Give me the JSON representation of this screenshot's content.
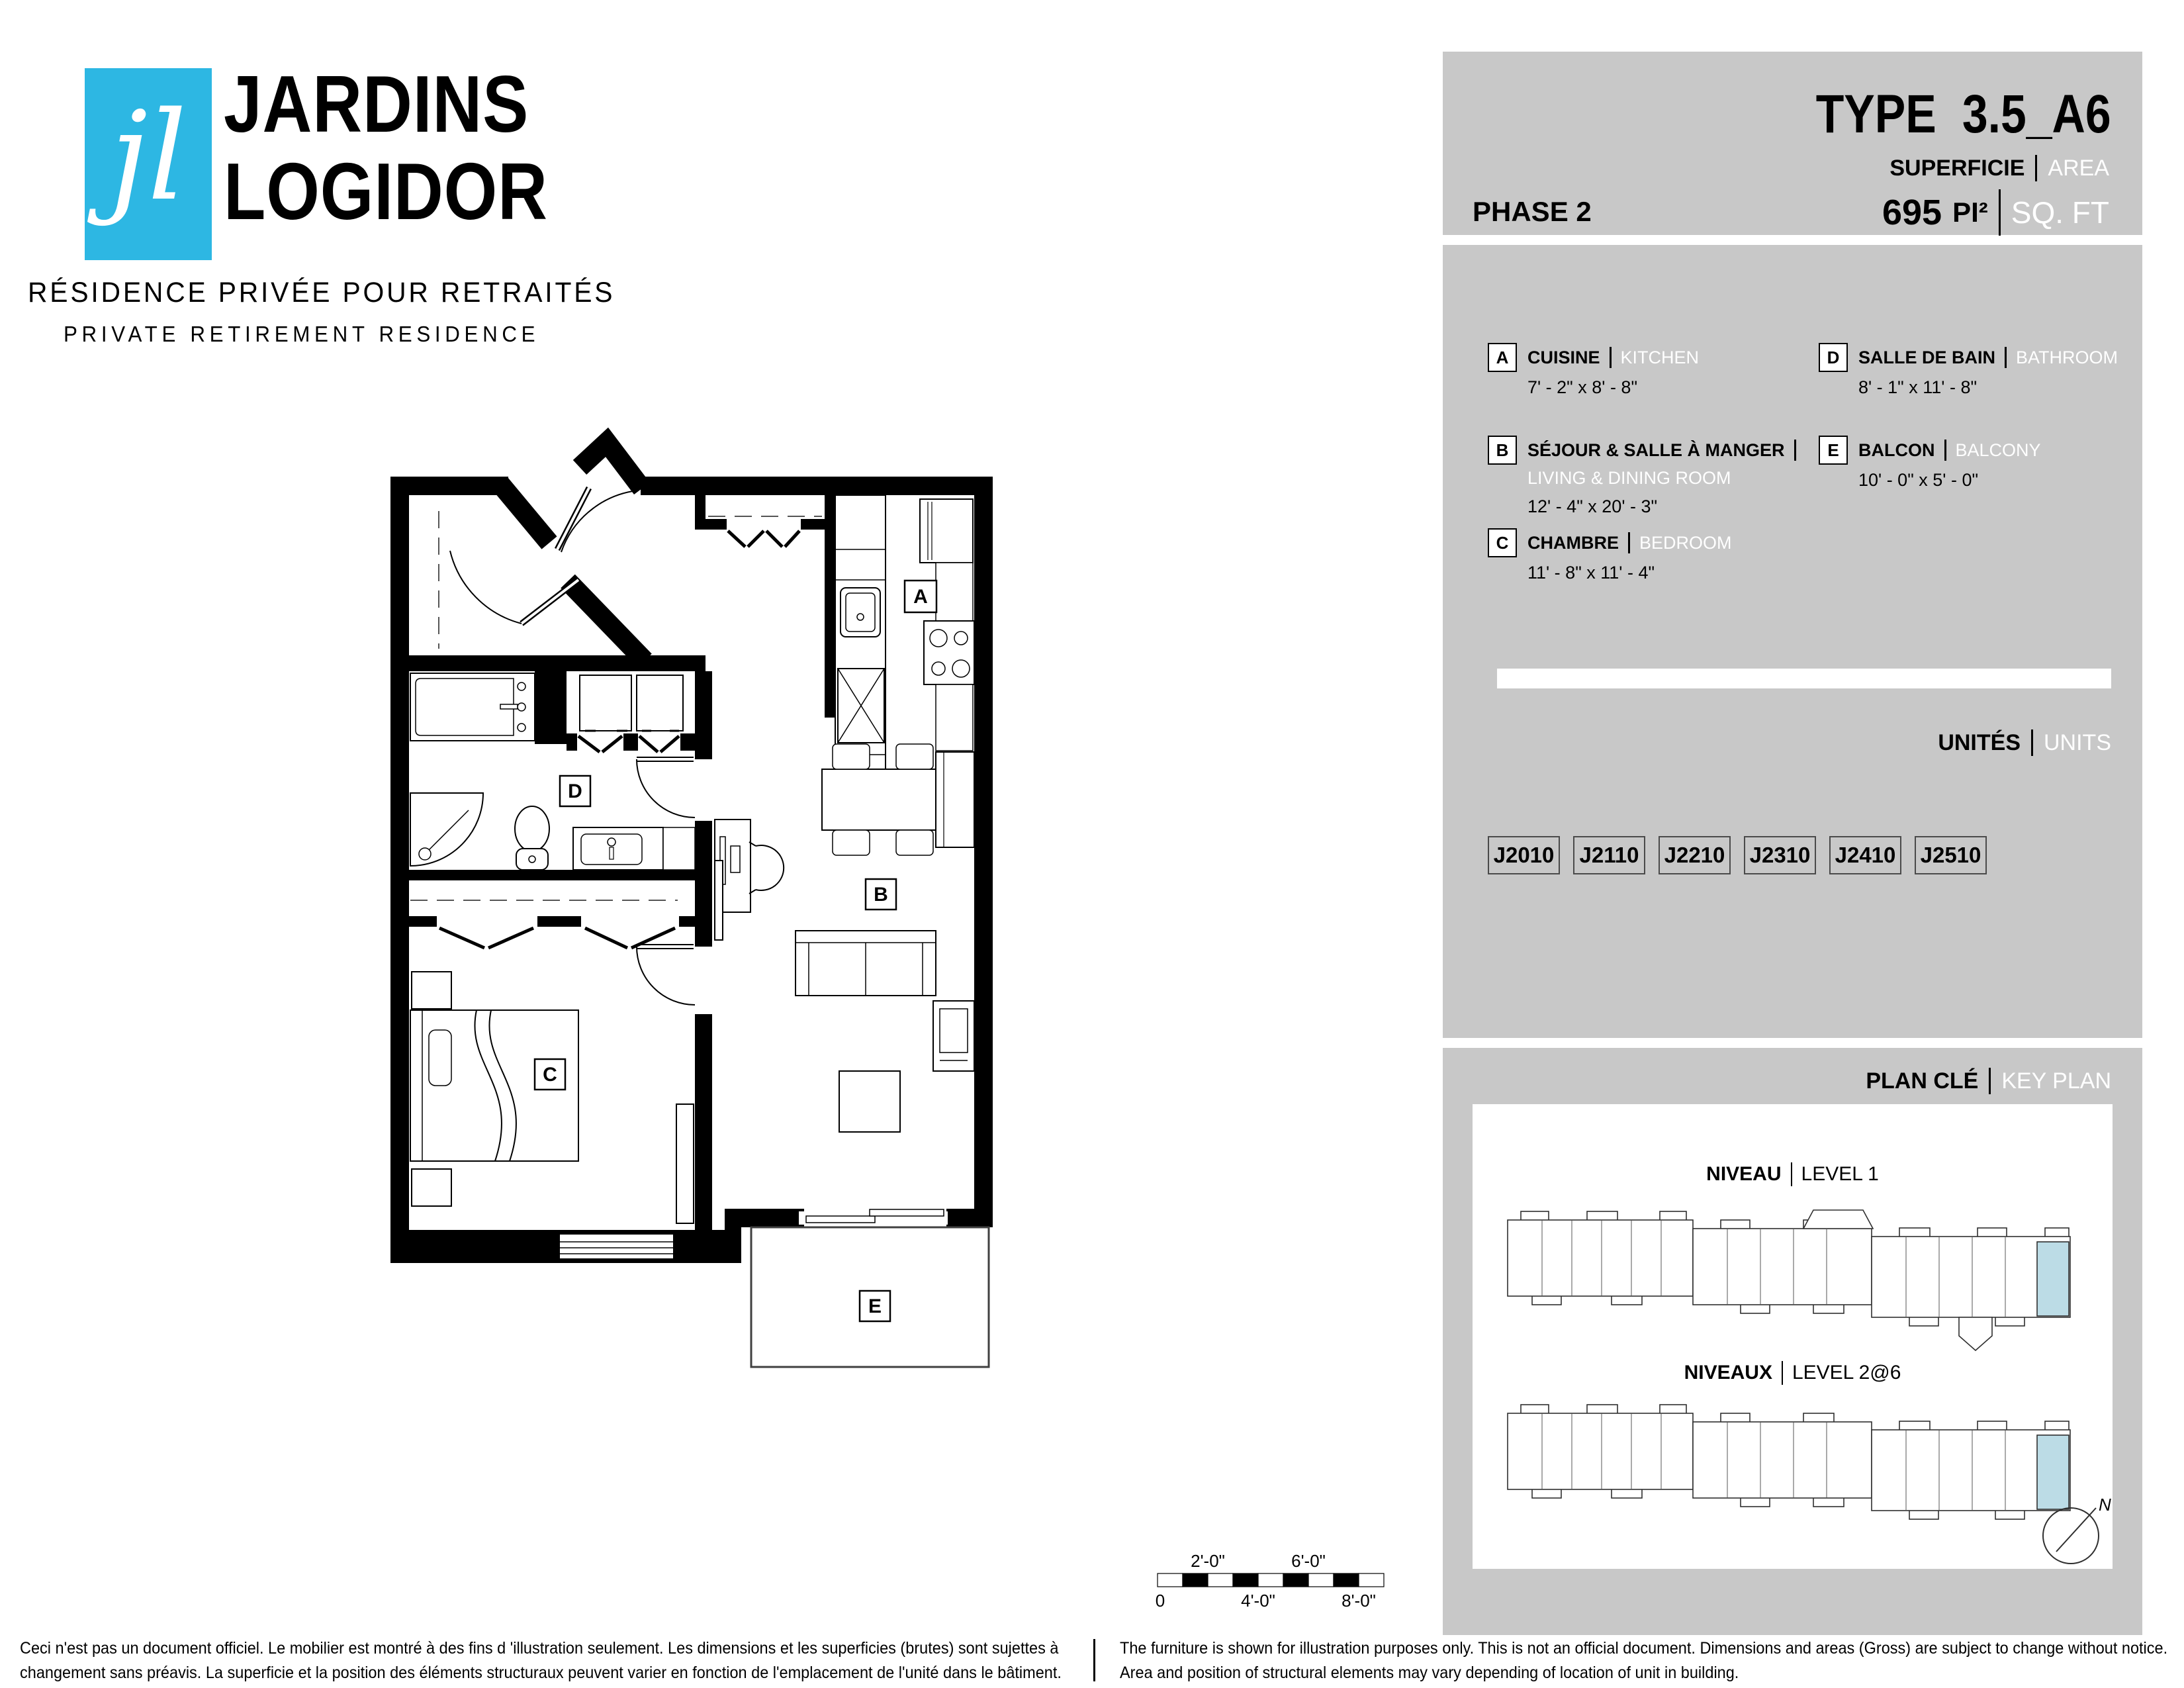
{
  "logo": {
    "mark": "jl",
    "name_line1": "JARDINS",
    "name_line2": "LOGIDOR",
    "tagline_fr": "RÉSIDENCE PRIVÉE POUR RETRAITÉS",
    "tagline_en": "PRIVATE RETIREMENT RESIDENCE"
  },
  "header": {
    "type_label": "TYPE",
    "type_value": "3.5_A6",
    "superficie_label": "SUPERFICIE",
    "area_label": "AREA",
    "phase": "PHASE 2",
    "area_value": "695",
    "area_unit_fr": "PI²",
    "area_unit_en": "SQ. FT"
  },
  "legend": {
    "items": [
      {
        "key": "A",
        "name_fr": "CUISINE",
        "name_en": "KITCHEN",
        "dims": "7' - 2\" x 8' - 8\""
      },
      {
        "key": "B",
        "name_fr": "SÉJOUR & SALLE À MANGER",
        "name_en": "LIVING & DINING ROOM",
        "dims": "12' - 4\" x 20' - 3\""
      },
      {
        "key": "C",
        "name_fr": "CHAMBRE",
        "name_en": "BEDROOM",
        "dims": "11' - 8\" x 11' - 4\""
      },
      {
        "key": "D",
        "name_fr": "SALLE DE BAIN",
        "name_en": "BATHROOM",
        "dims": "8' - 1\" x 11' - 8\""
      },
      {
        "key": "E",
        "name_fr": "BALCON",
        "name_en": "BALCONY",
        "dims": "10' - 0\" x 5' - 0\""
      }
    ]
  },
  "units": {
    "title_fr": "UNITÉS",
    "title_en": "UNITS",
    "list": [
      "J2010",
      "J2110",
      "J2210",
      "J2310",
      "J2410",
      "J2510"
    ]
  },
  "key_plan": {
    "title_fr": "PLAN CLÉ",
    "title_en": "KEY PLAN",
    "levels": [
      {
        "label_fr": "NIVEAU",
        "label_en": "LEVEL 1"
      },
      {
        "label_fr": "NIVEAUX",
        "label_en": "LEVEL 2@6"
      }
    ],
    "compass": "N"
  },
  "plan": {
    "room_labels": [
      "A",
      "B",
      "C",
      "D",
      "E"
    ]
  },
  "scale_bar": {
    "labels_above": [
      "2'-0\"",
      "6'-0\""
    ],
    "labels_below": [
      "0",
      "4'-0\"",
      "8'-0\""
    ]
  },
  "disclaimer": {
    "fr_line1": "Ceci n'est pas un document officiel.  Le mobilier est montré à des fins d 'illustration seulement.  Les dimensions et les superficies (brutes) sont sujettes à",
    "fr_line2": "changement sans préavis. La superficie et la position des éléments structuraux peuvent varier en fonction de l'emplacement de l'unité dans le bâtiment.",
    "en_line1": "The furniture is shown for illustration purposes only.  This is not an official document.  Dimensions and areas (Gross) are subject to change without notice.",
    "en_line2": "Area and position of structural elements may vary depending of location of unit in building."
  },
  "colors": {
    "brand_cyan": "#2db7e3",
    "panel_gray": "#c8c8c8",
    "unit_highlight": "#bcdce6",
    "wall_black": "#000000"
  }
}
